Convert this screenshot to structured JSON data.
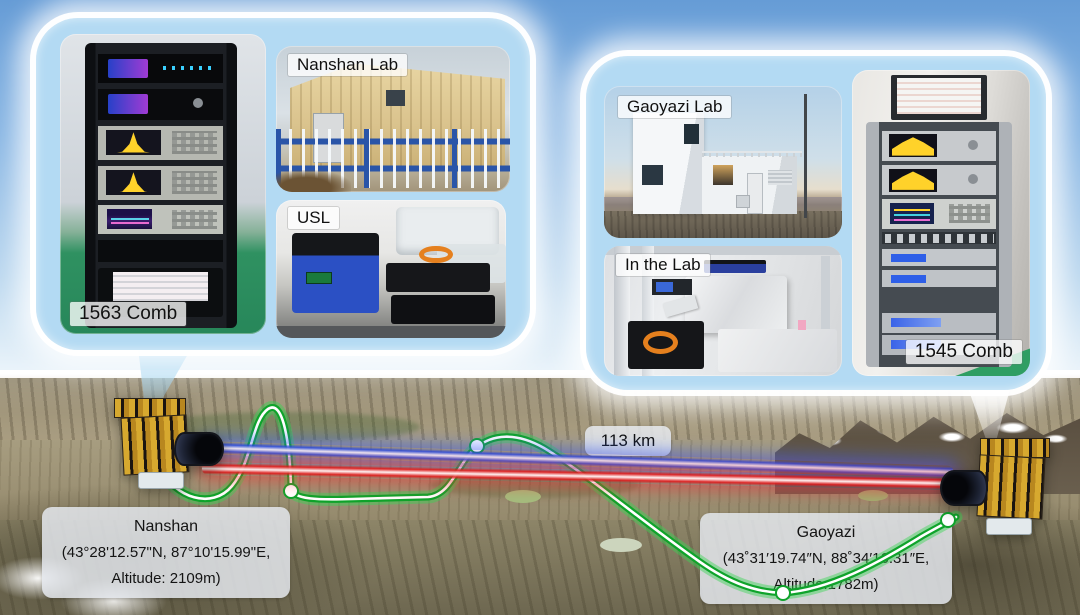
{
  "map": {
    "distance": "113 km",
    "nanshan": {
      "title": "Nanshan",
      "coords": "(43°28'12.57\"N, 87°10'15.99\"E,",
      "altitude": "Altitude: 2109m)"
    },
    "gaoyazi": {
      "title": "Gaoyazi",
      "coords": "(43˚31′19.74″N, 88˚34′16.31″E,",
      "altitude": "Altitude:1782m)"
    }
  },
  "left_callout": {
    "rack_label": "1563 Comb",
    "building_label": "Nanshan Lab",
    "lab_label": "USL"
  },
  "right_callout": {
    "building_label": "Gaoyazi Lab",
    "lab_label": "In the Lab",
    "rack_label": "1545 Comb"
  },
  "colors": {
    "beam_blue": "#2450e4",
    "beam_red": "#e41818",
    "fiber_green": "#0fa32b",
    "bubble_blue": "#b3daf3",
    "sky_top": "#669cd6",
    "label_bg": "#e4e8ed"
  }
}
